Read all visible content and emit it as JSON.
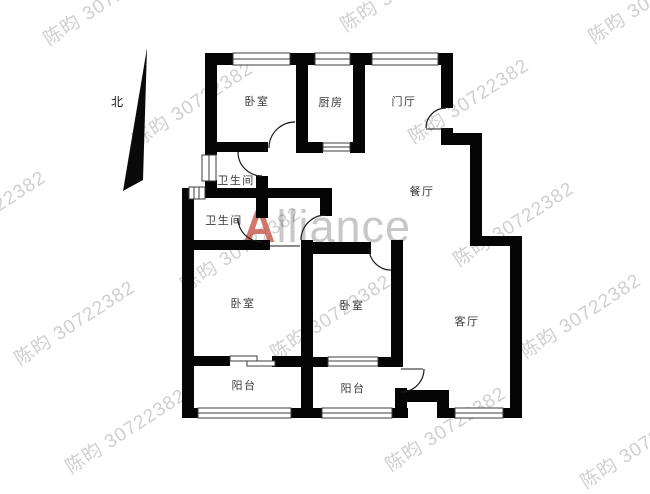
{
  "compass": {
    "label": "北"
  },
  "rooms": {
    "bedroom_top": {
      "label": "卧室"
    },
    "kitchen": {
      "label": "厨房"
    },
    "foyer": {
      "label": "门厅"
    },
    "dining": {
      "label": "餐厅"
    },
    "bathroom_upper": {
      "label": "卫生间"
    },
    "bathroom_lower": {
      "label": "卫生间"
    },
    "bedroom_left": {
      "label": "卧室"
    },
    "bedroom_middle": {
      "label": "卧室"
    },
    "living": {
      "label": "客厅"
    },
    "balcony_left": {
      "label": "阳台"
    },
    "balcony_right": {
      "label": "阳台"
    }
  },
  "watermark": {
    "text": "陈昀 30722382"
  },
  "brand_watermark": {
    "first_letter": "A",
    "rest": "lliance"
  },
  "colors": {
    "wall": "#050505",
    "room_label": "#3a3a3a",
    "watermark_gray": "#9a9a9a",
    "brand_red": "#c24a3a",
    "brand_gray": "#c6c6c6",
    "background": "#ffffff"
  }
}
